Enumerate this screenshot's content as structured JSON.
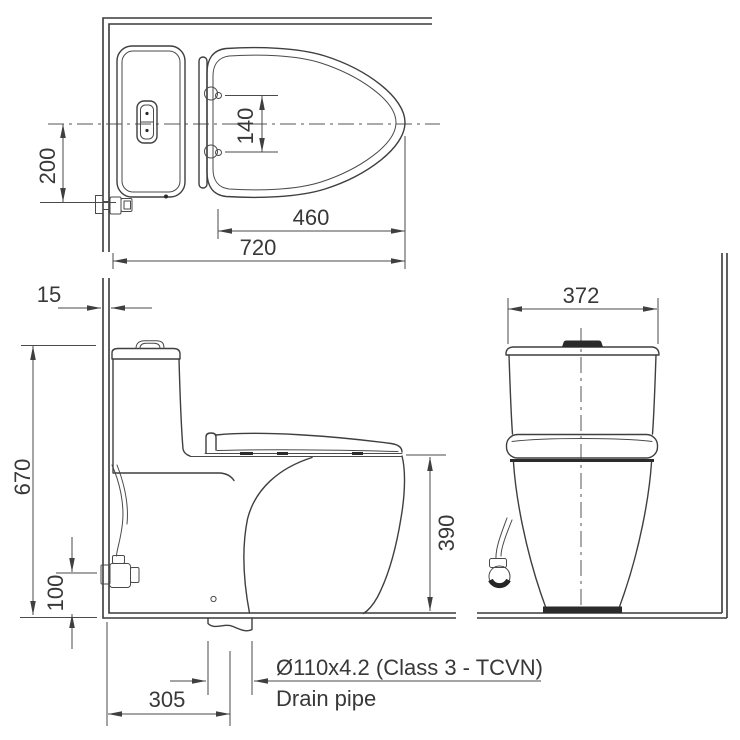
{
  "drawing": {
    "type": "technical-installation-drawing",
    "subject": "one-piece toilet, three orthographic views"
  },
  "colors": {
    "ink": "#3f3f3f",
    "dimension": "#4a4a4a",
    "text": "#383838",
    "background": "#ffffff"
  },
  "dimensions": {
    "center_offset": "200",
    "hinge_spacing": "140",
    "seat_length": "460",
    "total_length": "720",
    "wall_finish": "15",
    "total_height": "670",
    "valve_height": "100",
    "rim_height": "390",
    "drain_offset": "305",
    "tank_width": "372"
  },
  "annotations": {
    "drain_spec": "Ø110x4.2 (Class 3 - TCVN)",
    "drain_label": "Drain pipe"
  }
}
